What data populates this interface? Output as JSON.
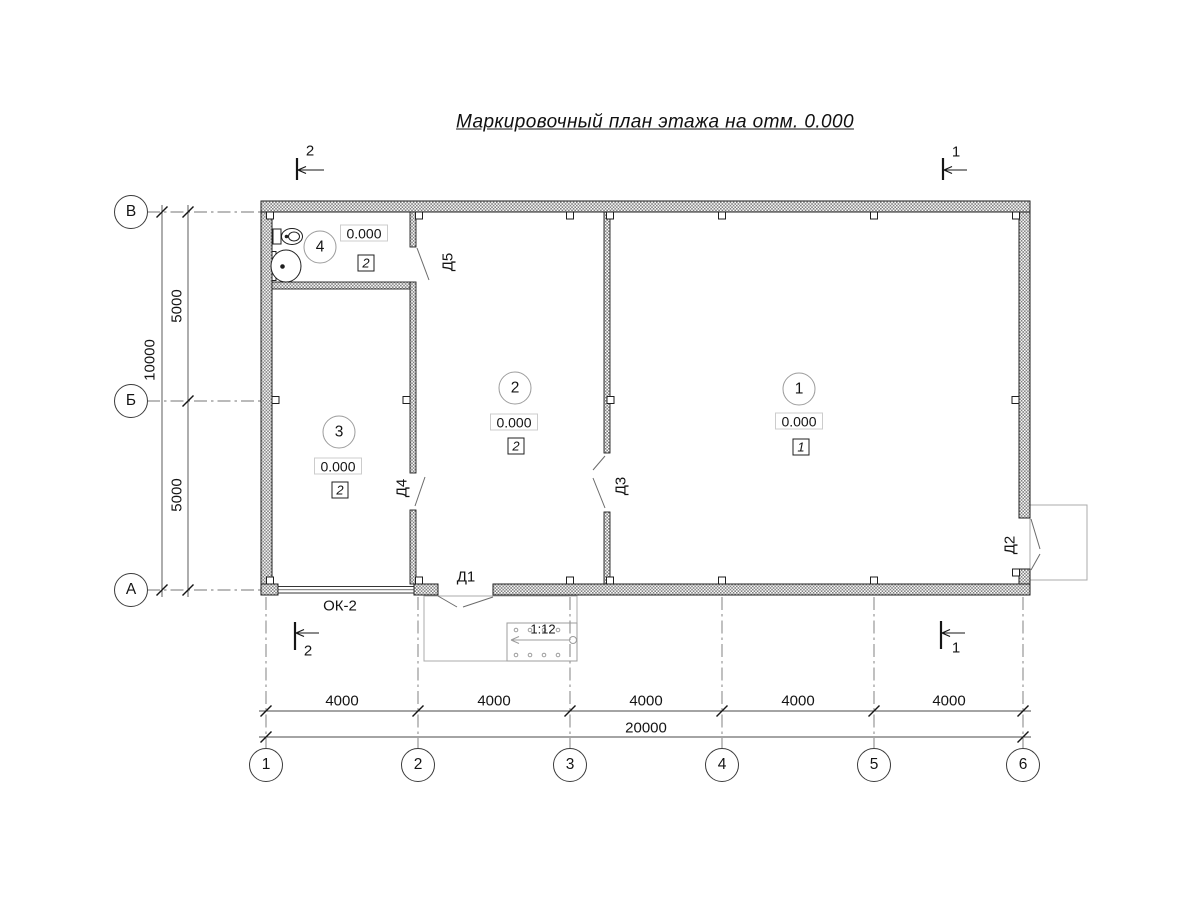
{
  "title": "Маркировочный план этажа на отм. 0.000",
  "axes": {
    "horizontal": [
      "1",
      "2",
      "3",
      "4",
      "5",
      "6"
    ],
    "vertical": [
      "В",
      "Б",
      "А"
    ]
  },
  "dimensions": {
    "spans": [
      "4000",
      "4000",
      "4000",
      "4000",
      "4000"
    ],
    "total": "20000",
    "left_spans": [
      "5000",
      "5000"
    ],
    "left_total": "10000"
  },
  "rooms": [
    {
      "number": "1",
      "elevation": "0.000",
      "floor": "1"
    },
    {
      "number": "2",
      "elevation": "0.000",
      "floor": "2"
    },
    {
      "number": "3",
      "elevation": "0.000",
      "floor": "2"
    },
    {
      "number": "4",
      "elevation": "0.000",
      "floor": "2"
    }
  ],
  "doors": {
    "d1": "Д1",
    "d2": "Д2",
    "d3": "Д3",
    "d4": "Д4",
    "d5": "Д5"
  },
  "window": {
    "label": "ОК-2"
  },
  "ramp": {
    "slope": "1:12"
  },
  "sections": {
    "cut1": "1",
    "cut2": "2"
  },
  "colors": {
    "line": "#141414",
    "wall_hatch": "#7e7e7e",
    "porch_line": "#ababab"
  }
}
